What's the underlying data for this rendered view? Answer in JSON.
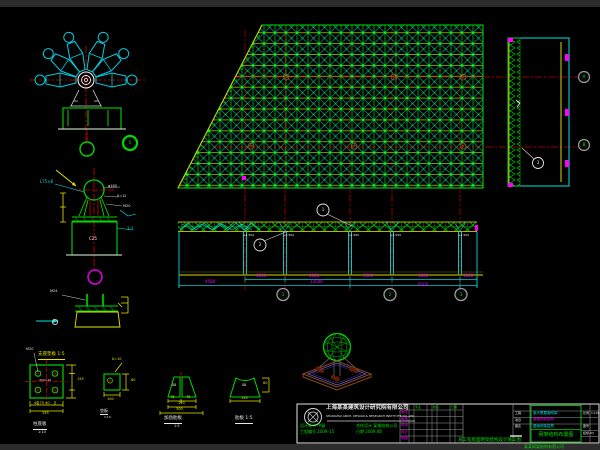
{
  "colors": {
    "background": "#000000",
    "frame_bar": "#2c2c2c",
    "grid_green": "#00d900",
    "cyan": "#00e5e5",
    "centerline_red": "#dd0000",
    "dim_yellow": "#e8e800",
    "ground_olive": "#8f8f00",
    "dim_text_magenta": "#ff00ff",
    "annotation_white": "#e8e8e8",
    "bubble_gray": "#9a9a9a",
    "base_brown": "#8a4a20",
    "base_purple": "#7060d0"
  },
  "spider_node": {
    "balloon": "5"
  },
  "support_detail": {
    "leader_left": "L75×6",
    "leader_r1": "φ180",
    "leader_r2": "δ=12",
    "leader_r3": "M20",
    "section_tag": "1-1",
    "pedestal_text": "C25"
  },
  "pedestal_detail": {
    "bolt_label": "M24",
    "caption": "支座垫板 1:5"
  },
  "plate_detail": {
    "leader": "M20",
    "center_text": "-350×20",
    "dims_bottom": "40 75 40",
    "total_bottom": "155",
    "total_side": "155",
    "caption": "柱底板",
    "scale": "1:10"
  },
  "washer_detail": {
    "leader": "δ=10",
    "dim_right": "60",
    "dim_bottom": "100",
    "caption": "垫板",
    "scale": "1:10"
  },
  "rib1_detail": {
    "text": "δ8",
    "dim_a": "75",
    "dim_b": "75",
    "total": "150",
    "total2": "300",
    "caption": "加劲肋板",
    "scale": "1:5"
  },
  "rib2_detail": {
    "text": "δ8",
    "dim_right": "60",
    "dim_bottom": "150",
    "caption": "肋板 1:5"
  },
  "elevation": {
    "mark": "+4.500",
    "balloon1": "1",
    "balloon2": "2",
    "dims_row1": [
      "3000",
      "6000",
      "3000",
      "6000",
      "1500"
    ],
    "dims_row2": [
      "4500",
      "13500",
      "6000"
    ],
    "bubbles": [
      "1",
      "2",
      "3"
    ]
  },
  "section_view": {
    "balloon": "3",
    "bubbles": [
      "A",
      "B"
    ]
  },
  "title_block": {
    "company_cn": "上海某某建筑设计研究院有限公司",
    "company_en": "SHANGHAI ARCH. DESIGN & RESEARCH INSTITUTE CO.,LTD",
    "cert_l1": "设计证书 甲级",
    "cert_l2": "工程编号 2009-15",
    "cert_r1": "合作设计 某钢结构公司",
    "cert_r2": "日期 2009.08",
    "sig_headers": [
      "专业",
      "姓名",
      "日期"
    ],
    "sig_rows": [
      "审定",
      "审核",
      "校对",
      "设计",
      "制图"
    ],
    "proj_label": "工程",
    "proj_value": "某大厦屋面网架",
    "item_label": "项目",
    "item_value": "屋面网架结构",
    "name_label": "图名",
    "drawing_title": "网架结构布置图",
    "scale_label": "比例",
    "scale_value": "1:100",
    "no_label": "图号",
    "no_value": "结施-03",
    "caption_center": "某工程屋面网架结构设计施工图",
    "caption_right": "某某网架结构有限公司"
  }
}
